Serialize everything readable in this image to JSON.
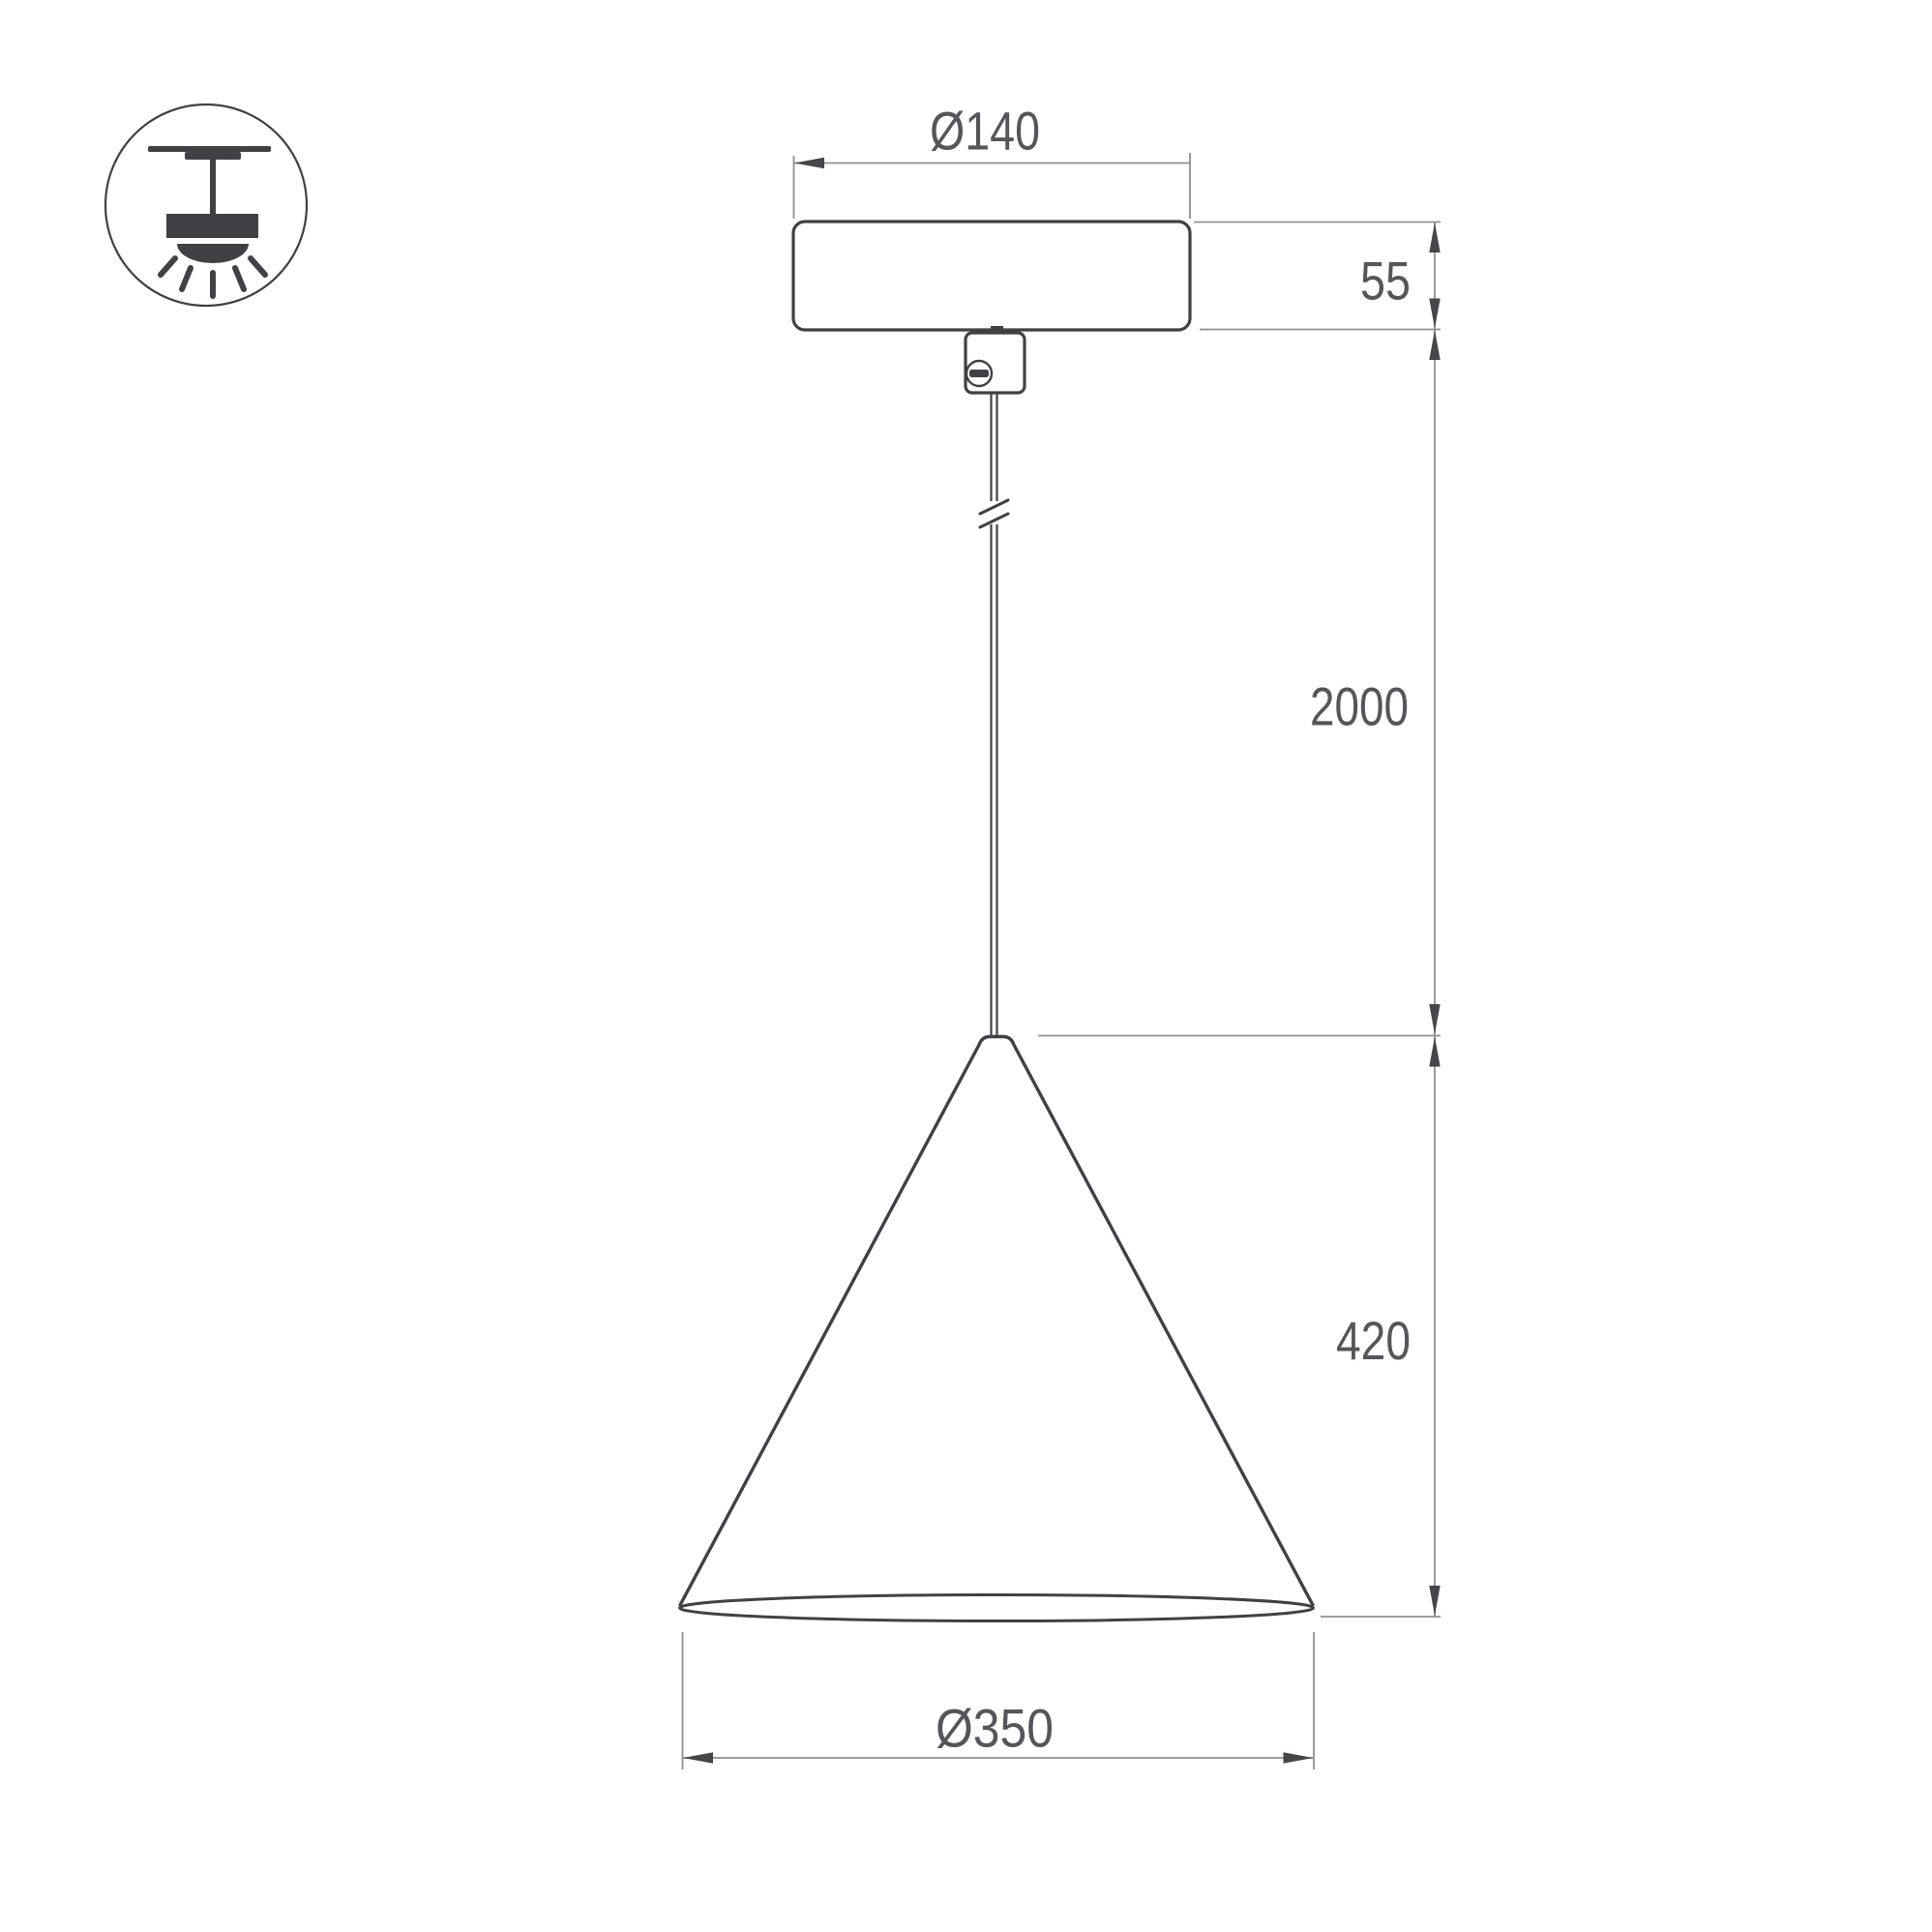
{
  "colors": {
    "outline": "#3f4145",
    "dimension_line": "#8f9092",
    "arrow": "#45474a",
    "text": "#54565a",
    "background": "#ffffff"
  },
  "icon": {
    "name": "pendant-ceiling-mount-icon"
  },
  "dimensions": {
    "canopy_diameter": {
      "label": "Ø140"
    },
    "canopy_height": {
      "label": "55"
    },
    "suspension_length": {
      "label": "2000"
    },
    "shade_height": {
      "label": "420"
    },
    "shade_diameter": {
      "label": "Ø350"
    }
  }
}
